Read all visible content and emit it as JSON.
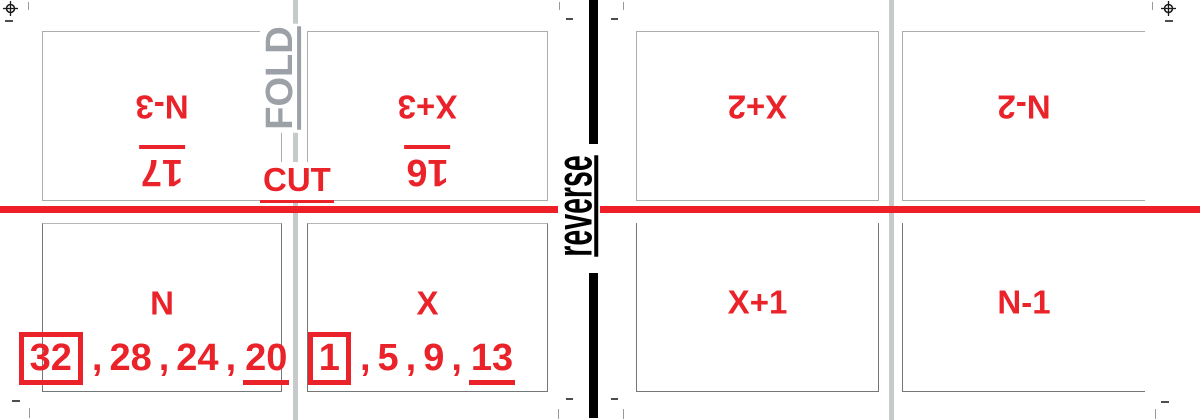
{
  "colors": {
    "red_text": "#e92329",
    "red_line": "#ee1f26",
    "fold_line_gray": "#c7caca",
    "fold_text_gray": "#9ba1a7",
    "reverse_black": "#000000"
  },
  "guides": {
    "fold_label": "FOLD",
    "cut_label": "CUT",
    "reverse_label": "reverse"
  },
  "separator": ",",
  "panels": {
    "top": [
      {
        "label": "N-3",
        "page": "17"
      },
      {
        "label": "X+3",
        "page": "16"
      },
      {
        "label": "X+2",
        "page": ""
      },
      {
        "label": "N-2",
        "page": ""
      }
    ],
    "bottom": [
      {
        "label": "N",
        "pages": [
          "32",
          "28",
          "24",
          "20"
        ]
      },
      {
        "label": "X",
        "pages": [
          "1",
          "5",
          "9",
          "13"
        ]
      },
      {
        "label": "X+1",
        "pages": []
      },
      {
        "label": "N-1",
        "pages": []
      }
    ]
  }
}
